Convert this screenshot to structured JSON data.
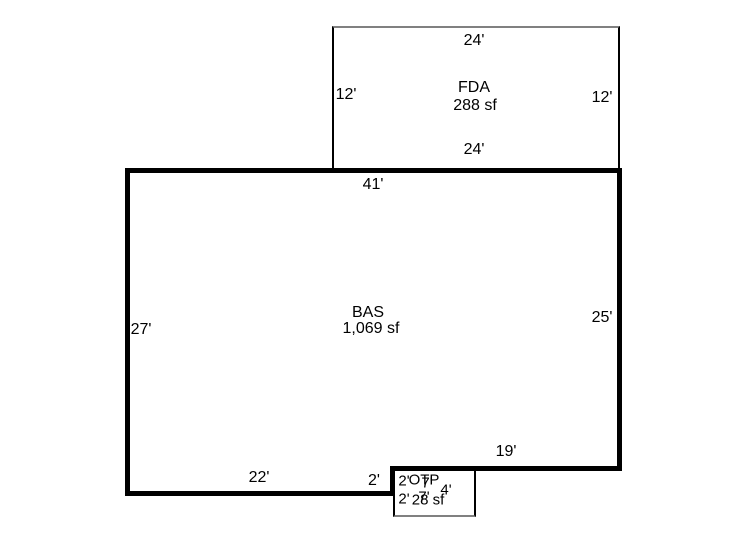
{
  "sketch": {
    "background": "#ffffff",
    "colors": {
      "main_wall": "#000000",
      "accessory_line": "#808080",
      "text": "#000000"
    },
    "areas": {
      "fda": {
        "label": "FDA",
        "area": "288 sf",
        "dim_top": "24'",
        "dim_left": "12'",
        "dim_right": "12'",
        "dim_bottom": "24'"
      },
      "bas": {
        "label": "BAS",
        "area": "1,069 sf",
        "dim_top": "41'",
        "dim_left": "27'",
        "dim_right": "25'",
        "dim_bottom_right": "19'",
        "dim_bottom_left": "22'",
        "dim_step": "2'"
      },
      "otp": {
        "label": "OTP",
        "area": "28 sf",
        "dim_top": "7'",
        "dim_bottom": "7'",
        "dim_right": "4'",
        "dim_left_upper": "2'",
        "dim_left_lower": "2'"
      }
    }
  }
}
